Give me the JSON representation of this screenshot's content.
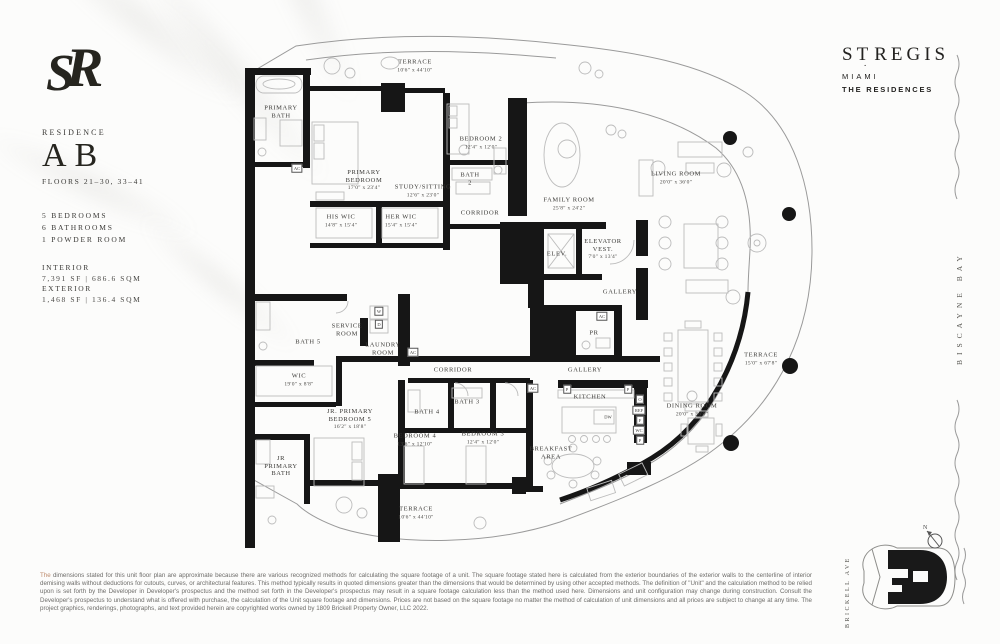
{
  "sidebar": {
    "residence_label": "RESIDENCE",
    "unit": "AB",
    "floors": "FLOORS 21–30, 33–41",
    "features": [
      "5 BEDROOMS",
      "6 BATHROOMS",
      "1 POWDER ROOM"
    ],
    "interior_label": "INTERIOR",
    "interior_area": "7,391 SF | 686.6 SQM",
    "exterior_label": "EXTERIOR",
    "exterior_area": "1,468 SF | 136.4 SQM"
  },
  "brand": {
    "part1": "ST",
    "part2": "REGIS",
    "city": "MIAMI",
    "sub": "THE RESIDENCES"
  },
  "context": {
    "bay": "BISCAYNE BAY",
    "street": "BRICKELL AVE",
    "compass": "N"
  },
  "plan": {
    "rooms": [
      {
        "name": "TERRACE",
        "dims": "10'6\" x 44'10\"",
        "x": 415,
        "y": 66
      },
      {
        "name": "PRIMARY\nBATH",
        "x": 281,
        "y": 112
      },
      {
        "name": "AC",
        "x": 297,
        "y": 168,
        "cls": "box"
      },
      {
        "name": "PRIMARY\nBEDROOM",
        "dims": "17'0\" x 23'4\"",
        "x": 364,
        "y": 180
      },
      {
        "name": "STUDY/SITTING",
        "dims": "12'6\" x 23'0\"",
        "x": 423,
        "y": 191
      },
      {
        "name": "BEDROOM 2",
        "dims": "12'4\" x 12'0\"",
        "x": 481,
        "y": 143
      },
      {
        "name": "BATH\n2",
        "x": 470,
        "y": 179
      },
      {
        "name": "CORRIDOR",
        "x": 480,
        "y": 213
      },
      {
        "name": "HIS WIC",
        "dims": "14'8\" x 15'4\"",
        "x": 341,
        "y": 221
      },
      {
        "name": "HER WIC",
        "dims": "15'4\" x 15'4\"",
        "x": 401,
        "y": 221
      },
      {
        "name": "FAMILY ROOM",
        "dims": "25'8\" x 24'2\"",
        "x": 569,
        "y": 204
      },
      {
        "name": "LIVING ROOM",
        "dims": "20'0\" x 36'0\"",
        "x": 676,
        "y": 178
      },
      {
        "name": "ELEV.",
        "x": 557,
        "y": 254
      },
      {
        "name": "ELEVATOR\nVEST.",
        "dims": "7'0\" x 13'4\"",
        "x": 603,
        "y": 249
      },
      {
        "name": "GALLERY",
        "x": 620,
        "y": 292
      },
      {
        "name": "SERVICE\nROOM",
        "x": 347,
        "y": 330
      },
      {
        "name": "BATH 5",
        "x": 308,
        "y": 342
      },
      {
        "name": "LAUNDRY\nROOM",
        "x": 383,
        "y": 349
      },
      {
        "name": "W",
        "x": 379,
        "y": 311,
        "cls": "box"
      },
      {
        "name": "D",
        "x": 379,
        "y": 324,
        "cls": "box"
      },
      {
        "name": "AC",
        "x": 413,
        "y": 352,
        "cls": "box"
      },
      {
        "name": "PR",
        "x": 594,
        "y": 333
      },
      {
        "name": "AC",
        "x": 602,
        "y": 316,
        "cls": "box"
      },
      {
        "name": "CORRIDOR",
        "x": 453,
        "y": 370
      },
      {
        "name": "WIC",
        "dims": "19'0\" x 8'8\"",
        "x": 299,
        "y": 380
      },
      {
        "name": "JR. PRIMARY\nBEDROOM 5",
        "dims": "16'2\" x 18'8\"",
        "x": 350,
        "y": 419
      },
      {
        "name": "BATH 4",
        "x": 427,
        "y": 412
      },
      {
        "name": "BATH 3",
        "x": 467,
        "y": 402
      },
      {
        "name": "BEDROOM 4",
        "dims": "13'6\" x 12'10\"",
        "x": 415,
        "y": 440
      },
      {
        "name": "BEDROOM 3",
        "dims": "12'4\" x 12'0\"",
        "x": 483,
        "y": 438
      },
      {
        "name": "JR\nPRIMARY\nBATH",
        "x": 281,
        "y": 466
      },
      {
        "name": "GALLERY",
        "x": 585,
        "y": 370
      },
      {
        "name": "AC",
        "x": 533,
        "y": 388,
        "cls": "box"
      },
      {
        "name": "KITCHEN",
        "x": 590,
        "y": 397
      },
      {
        "name": "DW",
        "x": 608,
        "y": 417,
        "cls": "sm"
      },
      {
        "name": "P",
        "x": 567,
        "y": 389,
        "cls": "box"
      },
      {
        "name": "P",
        "x": 628,
        "y": 389,
        "cls": "box"
      },
      {
        "name": "O",
        "x": 640,
        "y": 399,
        "cls": "box"
      },
      {
        "name": "REF",
        "x": 639,
        "y": 410,
        "cls": "box"
      },
      {
        "name": "F",
        "x": 640,
        "y": 420,
        "cls": "box"
      },
      {
        "name": "WC",
        "x": 639,
        "y": 430,
        "cls": "box"
      },
      {
        "name": "P",
        "x": 640,
        "y": 440,
        "cls": "box"
      },
      {
        "name": "BREAKFAST\nAREA",
        "x": 551,
        "y": 453
      },
      {
        "name": "DINING ROOM",
        "dims": "20'0\" x 36'0\"",
        "x": 692,
        "y": 410
      },
      {
        "name": "TERRACE",
        "dims": "15'0\" x 67'8\"",
        "x": 761,
        "y": 359
      },
      {
        "name": "TERRACE",
        "dims": "10'6\" x 44'10\"",
        "x": 416,
        "y": 513
      }
    ]
  },
  "footer": {
    "lead": "The",
    "rest": "dimensions stated for this unit floor plan are approximate because there are various recognized methods for calculating the square footage of a unit. The square footage stated here is calculated from the exterior boundaries of the exterior walls to the centerline of interior demising walls without deductions for cutouts, curves, or architectural features. This method typically results in quoted dimensions greater than the dimensions that would be determined by using other accepted methods. The definition of \"Unit\" and the calculation method to be relied upon is set forth by the Developer in Developer's prospectus and the method set forth in the Developer's prospectus may result in a square footage calculation less than the method used here. Dimensions and unit configuration may change during construction. Consult the Developer's prospectus to understand what is offered with purchase, the calculation of the Unit square footage and dimensions. Prices are not based on the square footage no matter the method of calculation of unit dimensions and all prices are subject to change at any time. The project graphics, renderings, photographs, and text provided herein are copyrighted works owned by 1809 Brickell Property Owner, LLC 2022."
  }
}
